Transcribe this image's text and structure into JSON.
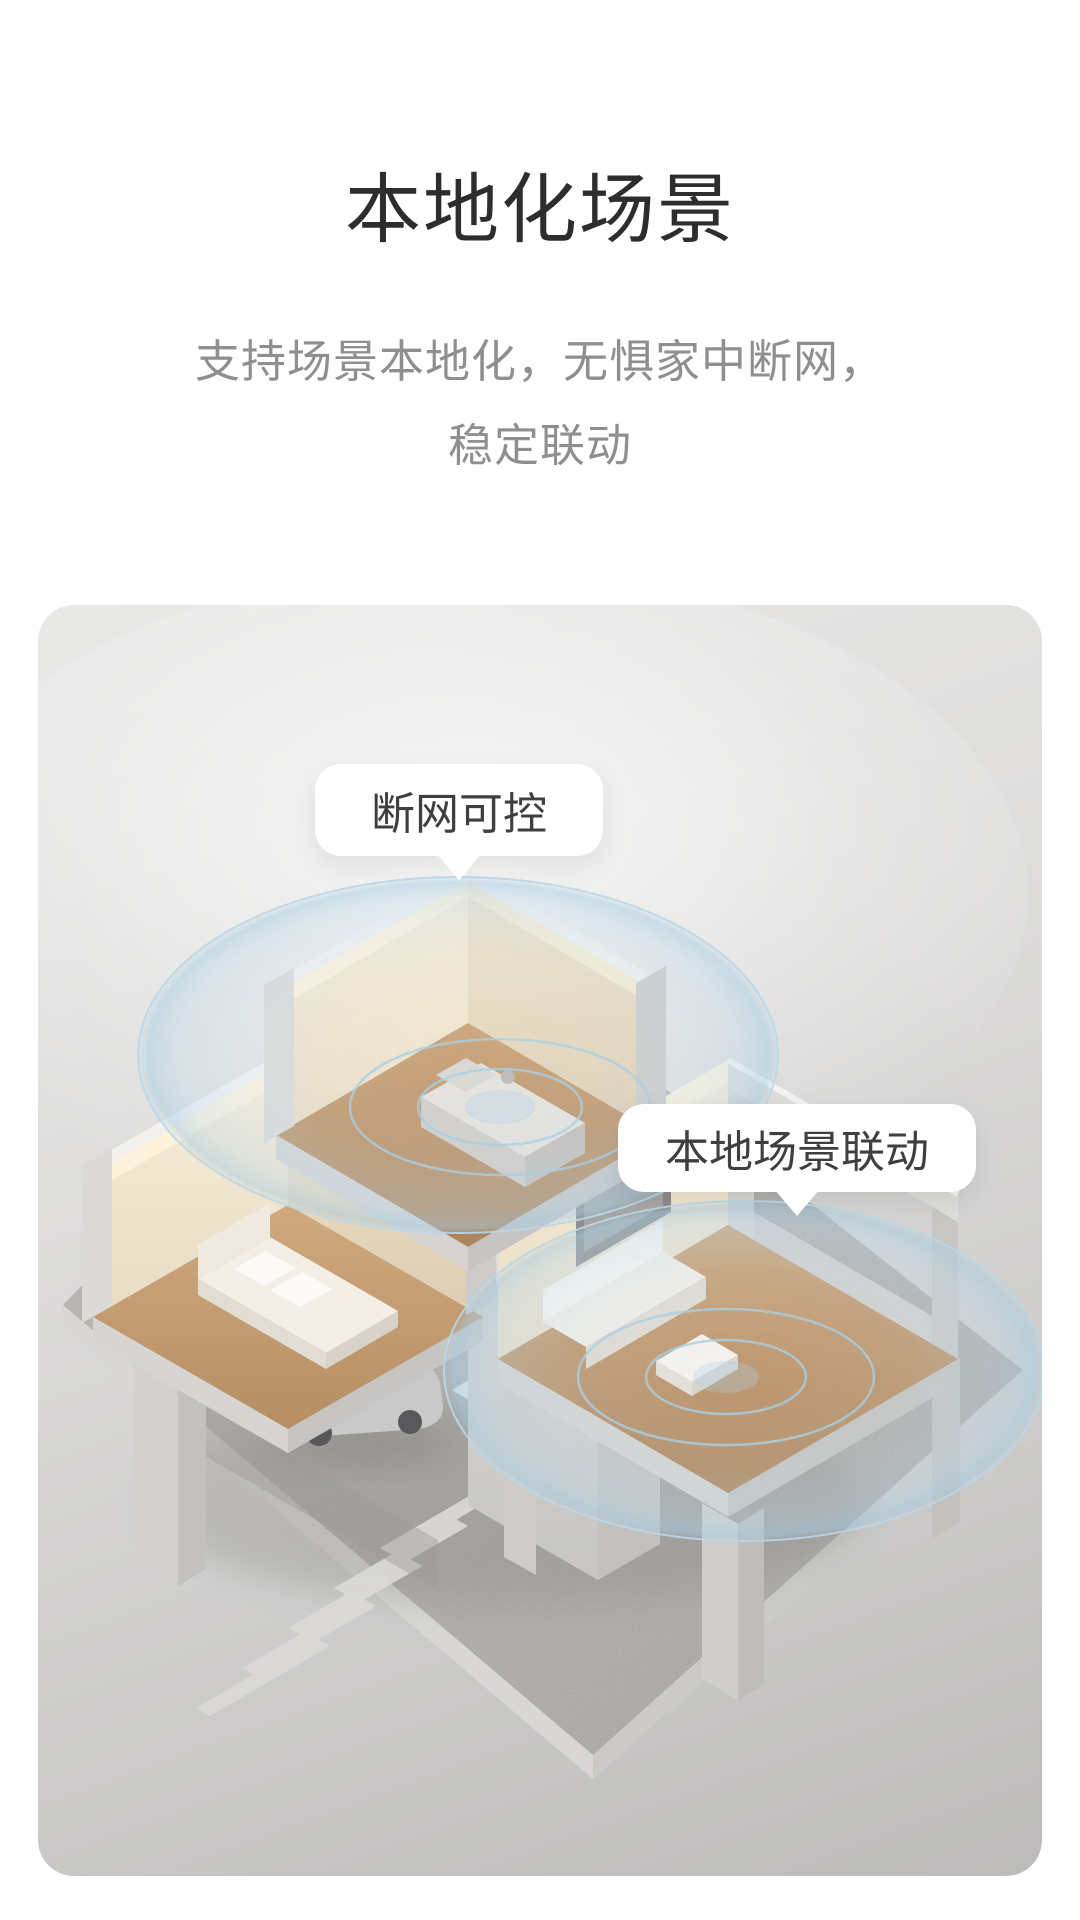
{
  "header": {
    "title": "本地化场景",
    "subtitle_line1": "支持场景本地化，无惧家中断网，",
    "subtitle_line2": "稳定联动"
  },
  "illustration": {
    "tooltips": [
      {
        "label": "断网可控"
      },
      {
        "label": "本地场景联动"
      }
    ],
    "colors": {
      "page_background": "#ffffff",
      "title_text": "#2d2d2d",
      "subtitle_text": "#8f8f8f",
      "tooltip_text": "#3f3f3f",
      "panel_gray_top": "#e8e8e7",
      "panel_gray_bottom": "#bcbbba",
      "plaza_granite": "#b0aeab",
      "ripple_blue": "#aed3e9",
      "wood_floor": "#c49f78",
      "warm_interior": "#f6ead2"
    }
  }
}
